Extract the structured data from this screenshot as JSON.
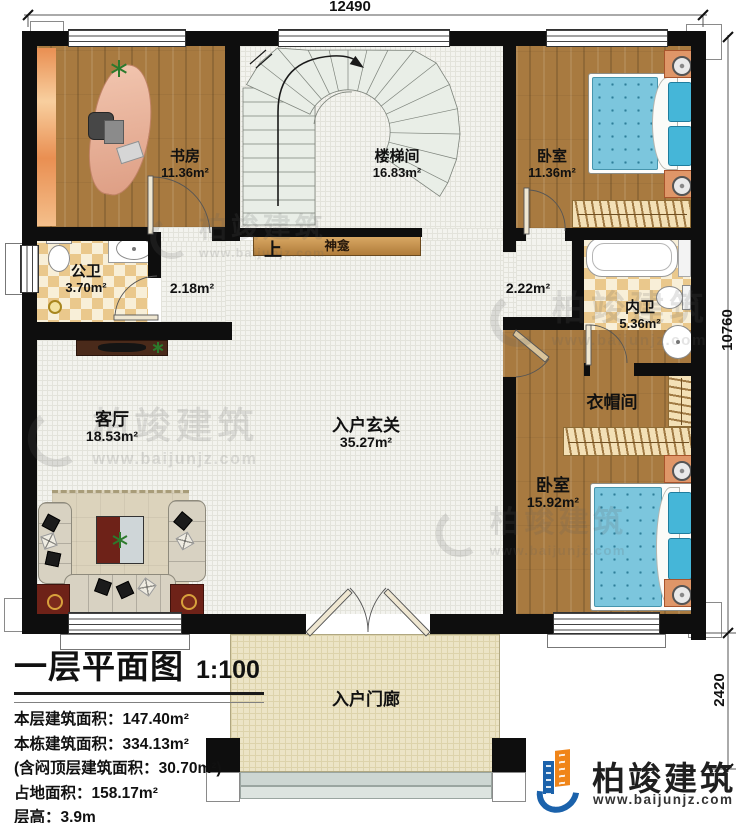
{
  "dimensions": {
    "top": "12490",
    "right_upper": "10760",
    "right_lower": "2420"
  },
  "rooms": {
    "study": {
      "name": "书房",
      "area": "11.36m²"
    },
    "stairwell": {
      "name": "楼梯间",
      "area": "16.83m²"
    },
    "bedroom1": {
      "name": "卧室",
      "area": "11.36m²"
    },
    "public_bath": {
      "name": "公卫",
      "area": "3.70m²"
    },
    "hall_left": {
      "area": "2.18m²"
    },
    "hall_right": {
      "area": "2.22m²"
    },
    "ensuite_bath": {
      "name": "内卫",
      "area": "5.36m²"
    },
    "living": {
      "name": "客厅",
      "area": "18.53m²"
    },
    "foyer": {
      "name": "入户玄关",
      "area": "35.27m²"
    },
    "cloakroom": {
      "name": "衣帽间"
    },
    "bedroom2": {
      "name": "卧室",
      "area": "15.92m²"
    },
    "porch": {
      "name": "入户门廊"
    },
    "shrine": {
      "name": "神龛"
    },
    "stair_up": {
      "label": "上"
    }
  },
  "title_block": {
    "title": "一层平面图",
    "scale": "1:100",
    "lines": [
      "本层建筑面积：147.40m²",
      "本栋建筑面积：334.13m²",
      "(含闷顶层建筑面积：30.70m²)",
      "占地面积：158.17m²",
      "层高：3.9m"
    ]
  },
  "brand": {
    "name": "柏竣建筑",
    "url": "www.baijunjz.com"
  },
  "watermark": {
    "name": "柏竣建筑",
    "url": "www.baijunjz.com"
  }
}
